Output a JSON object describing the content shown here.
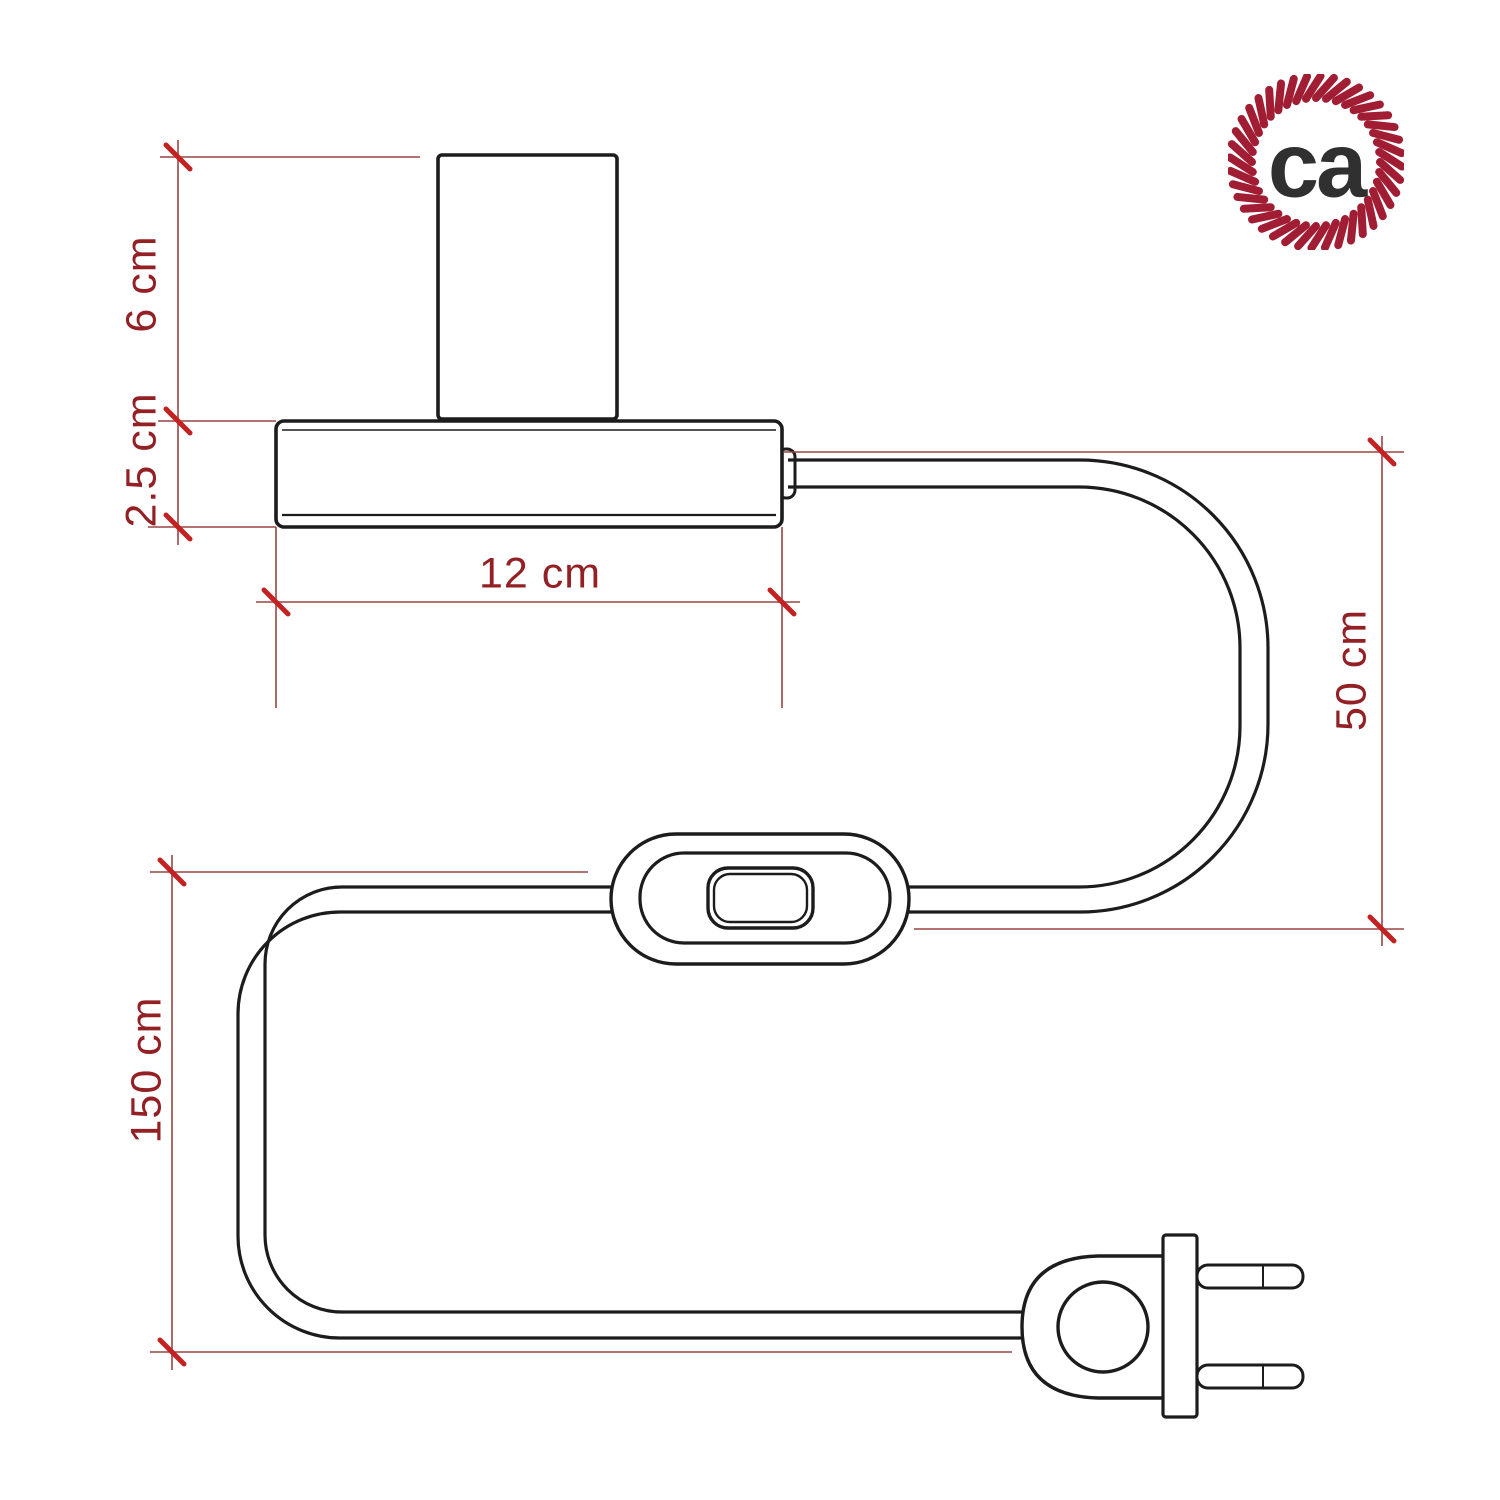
{
  "page": {
    "background": "#ffffff"
  },
  "diagram": {
    "labels": {
      "lamp_holder_height": "6 cm",
      "base_height": "2.5 cm",
      "base_width": "12 cm",
      "cable_lamp_to_switch": "50 cm",
      "cable_switch_to_plug": "150 cm"
    },
    "colors": {
      "outline": "#1c1c1c",
      "dimension_line": "#9a4545",
      "tick": "#c32222",
      "dimension_text": "#932025"
    }
  },
  "logo": {
    "text": "ca",
    "ring_color": "#a01d33",
    "text_color": "#303030"
  }
}
